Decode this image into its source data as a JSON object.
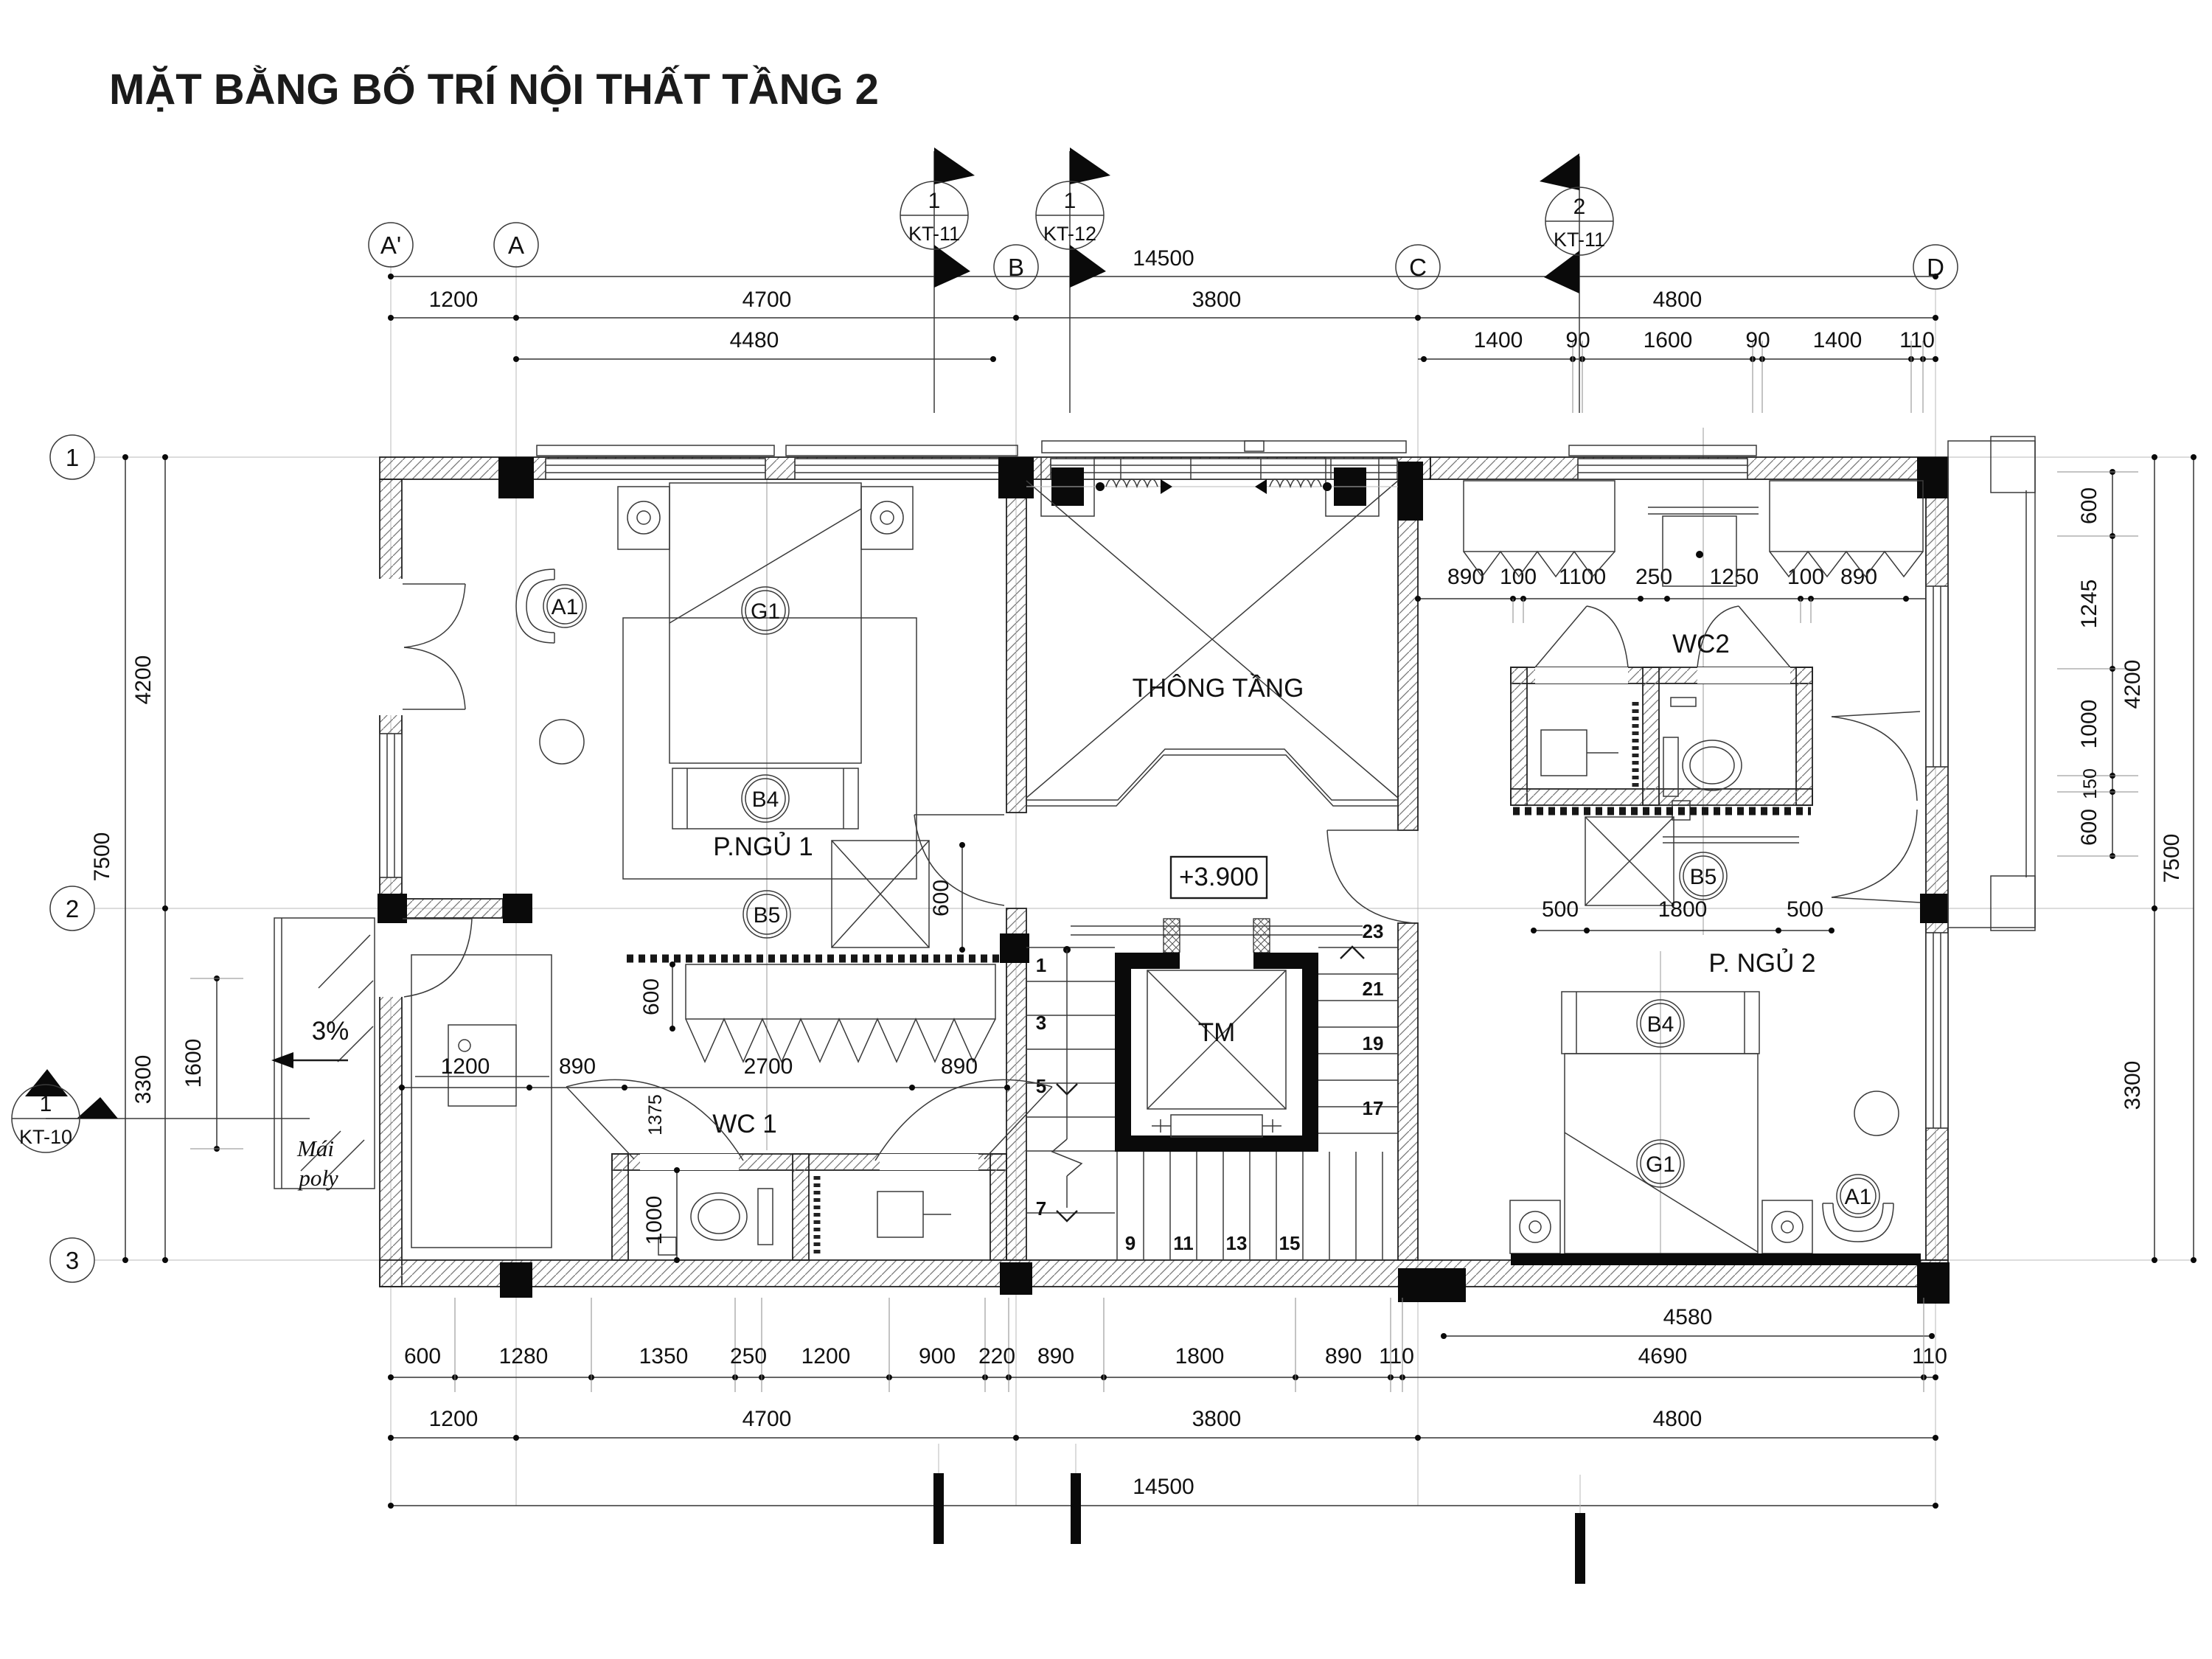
{
  "title": "MẶT BẰNG BỐ TRÍ NỘI THẤT TẦNG 2",
  "grid": {
    "cols": [
      "A'",
      "A",
      "B",
      "C",
      "D"
    ],
    "rows": [
      "1",
      "2",
      "3"
    ]
  },
  "markers": {
    "kt11a_num": "1",
    "kt11a_sheet": "KT-11",
    "kt12_num": "1",
    "kt12_sheet": "KT-12",
    "kt11b_num": "2",
    "kt11b_sheet": "KT-11",
    "kt10_num": "1",
    "kt10_sheet": "KT-10"
  },
  "rooms": {
    "bedroom1": "P.NGỦ 1",
    "void": "THÔNG TẦNG",
    "wc1": "WC 1",
    "wc2": "WC2",
    "bedroom2": "P. NGỦ 2",
    "roof_line1": "Mái",
    "roof_line2": "poly",
    "slope": "3%",
    "level": "+3.900",
    "elevator": "TM"
  },
  "tags": {
    "armchair1": "A1",
    "bed1": "G1",
    "bench1": "B4",
    "vanity1": "B5",
    "armchair2": "A1",
    "bed2": "G1",
    "bench2": "B4",
    "vanity2": "B5"
  },
  "stairs": {
    "left": [
      "1",
      "3",
      "5",
      "7"
    ],
    "bottom": [
      "9",
      "11",
      "13",
      "15"
    ],
    "right": [
      "17",
      "19",
      "21",
      "23"
    ]
  },
  "dims": {
    "top_overall": "14500",
    "top_spans": [
      "1200",
      "4700",
      "3800",
      "4800"
    ],
    "top_4480": "4480",
    "top_cd": [
      "1400",
      "90",
      "1600",
      "90",
      "1400",
      "110"
    ],
    "left_7500": "7500",
    "left_4200": "4200",
    "left_3300": "3300",
    "left_1600": "1600",
    "right_7500": "7500",
    "right_4200": "4200",
    "right_3300": "3300",
    "right_chain": [
      "600",
      "1245",
      "1000",
      "150",
      "600"
    ],
    "wc2_chain": [
      "890",
      "100",
      "1100",
      "250",
      "1250",
      "100",
      "890"
    ],
    "wc2_lower": [
      "500",
      "1800",
      "500"
    ],
    "wc1_chain": [
      "1200",
      "890",
      "2700",
      "890"
    ],
    "wc1_1375": "1375",
    "wc1_1000": "1000",
    "vanity_600a": "600",
    "vanity_600b": "600",
    "bottom_detail": [
      "600",
      "1280",
      "1350",
      "250",
      "1200",
      "900",
      "220",
      "890",
      "1800",
      "890",
      "110",
      "4690",
      "110"
    ],
    "bottom_4580": "4580",
    "bottom_spans": [
      "1200",
      "4700",
      "3800",
      "4800"
    ],
    "bottom_overall": "14500"
  }
}
